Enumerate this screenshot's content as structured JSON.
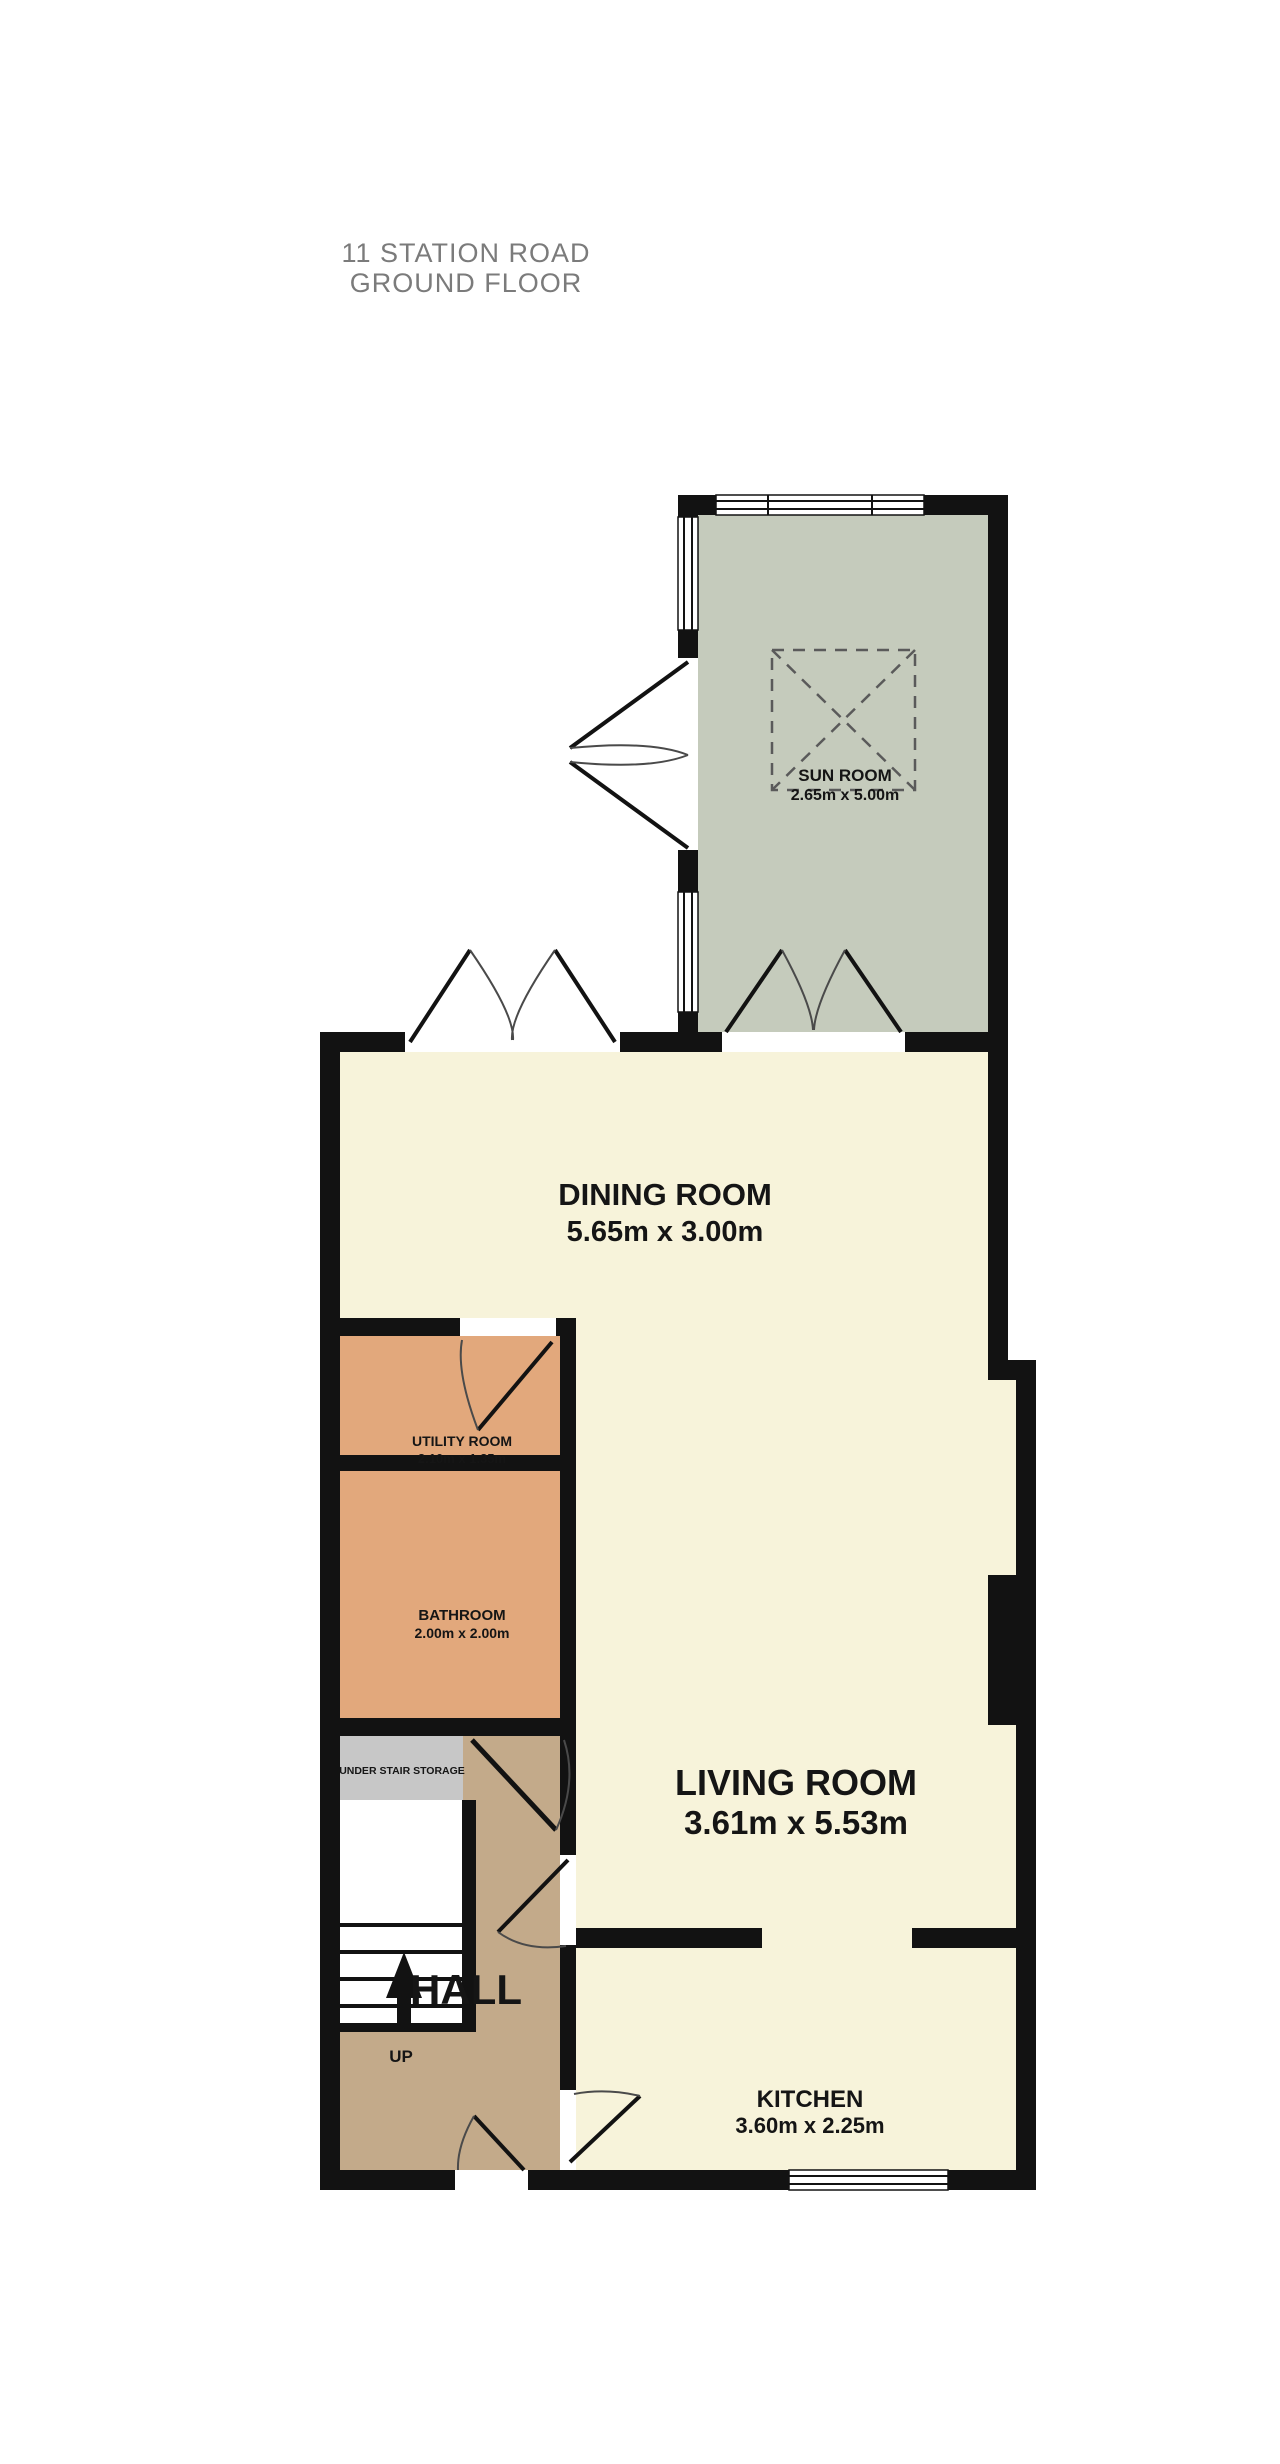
{
  "title": {
    "line1": "11 STATION ROAD",
    "line2": "GROUND FLOOR",
    "color": "#7b7b7b"
  },
  "rooms": {
    "sun_room": {
      "name": "SUN ROOM",
      "dims": "2.65m x 5.00m"
    },
    "dining_room": {
      "name": "DINING ROOM",
      "dims": "5.65m x 3.00m"
    },
    "utility_room": {
      "name": "UTILITY ROOM",
      "dims": "2.10m x 1.35m"
    },
    "bathroom": {
      "name": "BATHROOM",
      "dims": "2.00m x 2.00m"
    },
    "under_stair_storage": {
      "name": "UNDER STAIR STORAGE"
    },
    "hall": {
      "name": "HALL"
    },
    "living_room": {
      "name": "LIVING ROOM",
      "dims": "3.61m x 5.53m"
    },
    "kitchen": {
      "name": "KITCHEN",
      "dims": "3.60m x 2.25m"
    }
  },
  "stairs": {
    "direction_label": "UP"
  },
  "palette": {
    "wall": "#121212",
    "cream_floor": "#f7f3da",
    "sun_room_floor": "#c5cbbc",
    "utility_bathroom_floor": "#e2a87c",
    "hall_floor": "#c3aa8a",
    "storage_floor": "#c7c7c7",
    "background": "#ffffff"
  }
}
